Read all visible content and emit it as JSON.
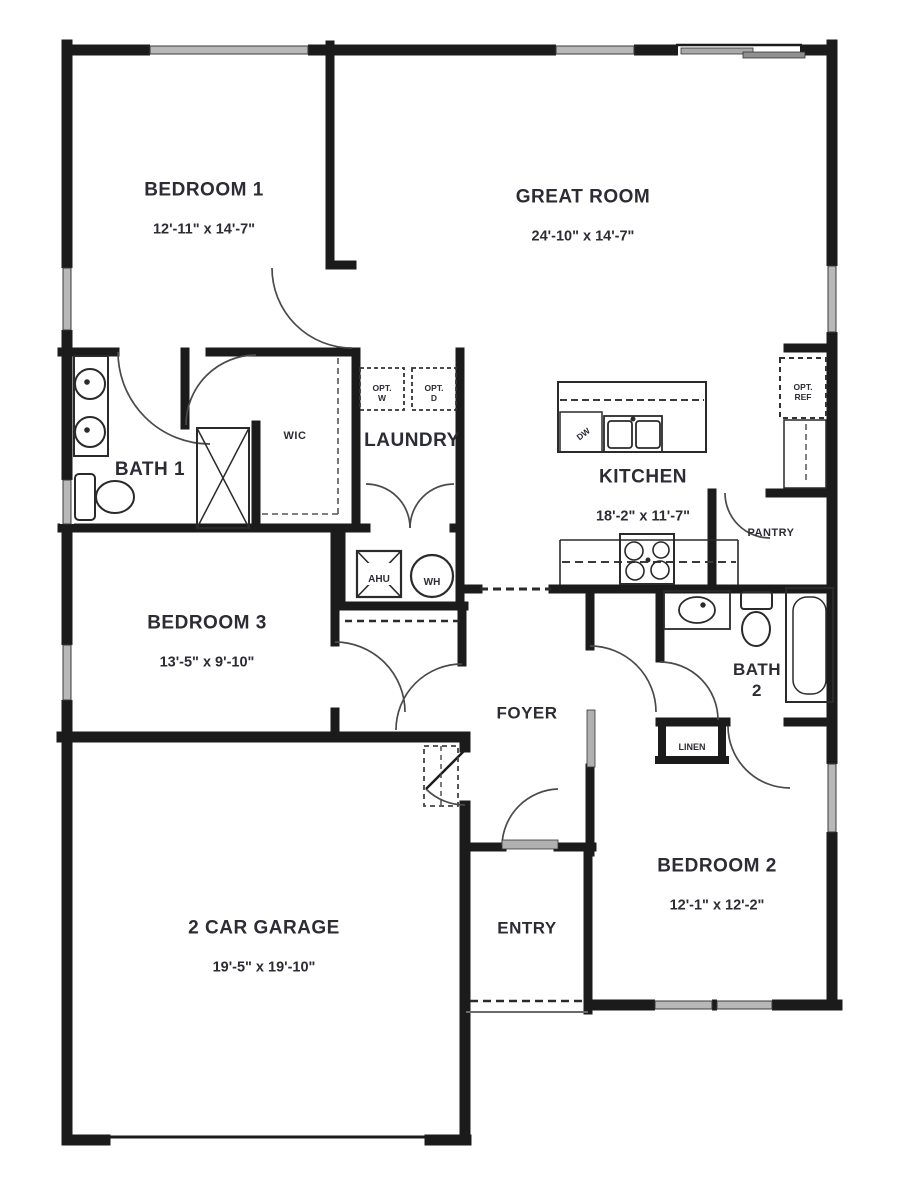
{
  "plan": {
    "bg": "#ffffff",
    "wall_color": "#1b1b1b",
    "window_color": "#b8b8b8",
    "label_color": "#2c2c34"
  },
  "rooms": {
    "bedroom1": {
      "name": "BEDROOM 1",
      "dims": "12'-11\" x 14'-7\""
    },
    "great_room": {
      "name": "GREAT ROOM",
      "dims": "24'-10\" x 14'-7\""
    },
    "kitchen": {
      "name": "KITCHEN",
      "dims": "18'-2\" x 11'-7\""
    },
    "bedroom3": {
      "name": "BEDROOM 3",
      "dims": "13'-5\" x 9'-10\""
    },
    "bedroom2": {
      "name": "BEDROOM 2",
      "dims": "12'-1\" x 12'-2\""
    },
    "garage": {
      "name": "2 CAR GARAGE",
      "dims": "19'-5\" x 19'-10\""
    },
    "bath1": {
      "name": "BATH 1"
    },
    "bath2": {
      "name": "BATH\n2"
    },
    "laundry": {
      "name": "LAUNDRY"
    },
    "foyer": {
      "name": "FOYER"
    },
    "entry": {
      "name": "ENTRY"
    },
    "wic": {
      "name": "WIC"
    },
    "pantry": {
      "name": "PANTRY"
    },
    "linen": {
      "name": "LINEN"
    }
  },
  "fixtures": {
    "ahu": "AHU",
    "wh": "WH",
    "dw": "DW",
    "opt_w": "OPT.\nW",
    "opt_d": "OPT.\nD",
    "opt_ref": "OPT.\nREF"
  }
}
